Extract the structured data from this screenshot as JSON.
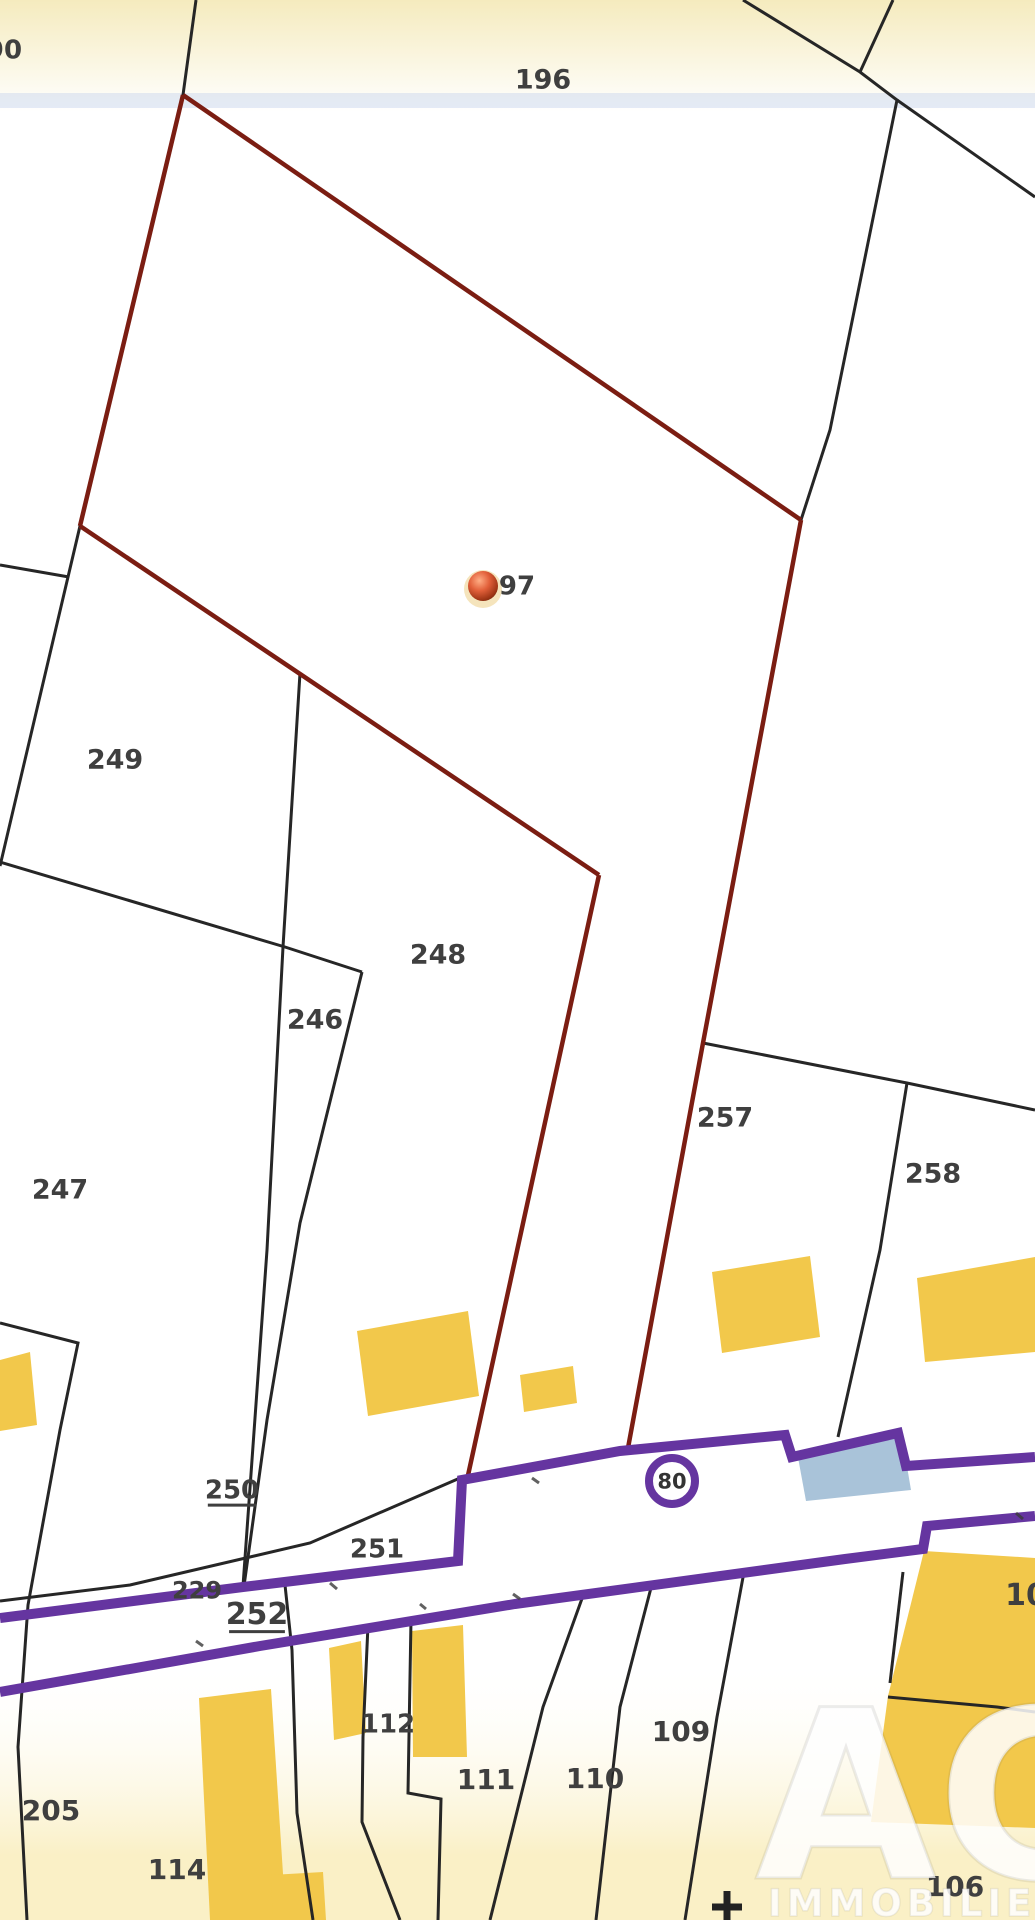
{
  "map": {
    "title": "Cadastral parcel map",
    "background": {
      "top_tint": "#f5ebbe",
      "paper": "#ffffff",
      "bottom_tint": "#faf0c6",
      "blue_band": "rgba(190,205,235,0.40)"
    },
    "palette": {
      "boundary": "#262626",
      "highlight": "#7b1d12",
      "road": "#6535a0",
      "building": "#f2c84b",
      "building_blue": "#a9c3d9",
      "label": "#3f3f3f",
      "badge_text": "#333333",
      "watermark": "#ffffff"
    },
    "parcel_labels": [
      {
        "text": "90",
        "x": 4,
        "y": 49,
        "size": 26
      },
      {
        "text": "196",
        "x": 543,
        "y": 79,
        "size": 27
      },
      {
        "text": "249",
        "x": 115,
        "y": 759,
        "size": 27
      },
      {
        "text": "247",
        "x": 60,
        "y": 1189,
        "size": 27
      },
      {
        "text": "246",
        "x": 315,
        "y": 1019,
        "size": 27
      },
      {
        "text": "248",
        "x": 438,
        "y": 954,
        "size": 27
      },
      {
        "text": "257",
        "x": 725,
        "y": 1117,
        "size": 27
      },
      {
        "text": "258",
        "x": 933,
        "y": 1173,
        "size": 27
      },
      {
        "text": "250",
        "x": 232,
        "y": 1489,
        "size": 26,
        "underline": true
      },
      {
        "text": "251",
        "x": 377,
        "y": 1548,
        "size": 26
      },
      {
        "text": "229",
        "x": 197,
        "y": 1590,
        "size": 24
      },
      {
        "text": "252",
        "x": 257,
        "y": 1613,
        "size": 30,
        "underline": true
      },
      {
        "text": "205",
        "x": 51,
        "y": 1810,
        "size": 28
      },
      {
        "text": "114",
        "x": 177,
        "y": 1869,
        "size": 28
      },
      {
        "text": "112",
        "x": 388,
        "y": 1723,
        "size": 26
      },
      {
        "text": "111",
        "x": 486,
        "y": 1779,
        "size": 28
      },
      {
        "text": "110",
        "x": 595,
        "y": 1778,
        "size": 28
      },
      {
        "text": "109",
        "x": 681,
        "y": 1731,
        "size": 28
      },
      {
        "text": "106",
        "x": 955,
        "y": 1886,
        "size": 28
      },
      {
        "text": "10",
        "x": 1026,
        "y": 1594,
        "size": 30
      }
    ],
    "road_badge": {
      "text": "80",
      "x": 672,
      "y": 1481,
      "outer_r": 27,
      "ring_width": 8,
      "font_size": 21
    },
    "marker": {
      "label": "97",
      "x": 483,
      "y": 586,
      "r": 15,
      "halo_r": 19,
      "label_x": 517,
      "label_y": 585,
      "label_size": 26
    },
    "cross_symbol": {
      "x": 727,
      "y": 1906,
      "arm": 15,
      "stroke_width": 7
    },
    "black_lines": [
      [
        [
          196,
          0
        ],
        [
          183,
          95
        ],
        [
          80,
          526
        ],
        [
          0,
          866
        ]
      ],
      [
        [
          743,
          0
        ],
        [
          860,
          72
        ],
        [
          897,
          100
        ],
        [
          830,
          430
        ],
        [
          801,
          520
        ]
      ],
      [
        [
          893,
          0
        ],
        [
          860,
          72
        ]
      ],
      [
        [
          897,
          100
        ],
        [
          1035,
          197
        ]
      ],
      [
        [
          0,
          565
        ],
        [
          69,
          577
        ]
      ],
      [
        [
          0,
          862
        ],
        [
          285,
          947
        ],
        [
          362,
          972
        ]
      ],
      [
        [
          300,
          673
        ],
        [
          283,
          947
        ],
        [
          267,
          1250
        ],
        [
          243,
          1586
        ]
      ],
      [
        [
          362,
          972
        ],
        [
          300,
          1223
        ],
        [
          267,
          1420
        ],
        [
          244,
          1586
        ]
      ],
      [
        [
          0,
          1323
        ],
        [
          78,
          1343
        ],
        [
          60,
          1430
        ],
        [
          38,
          1550
        ],
        [
          28,
          1605
        ],
        [
          18,
          1747
        ],
        [
          27,
          1920
        ]
      ],
      [
        [
          460,
          1478
        ],
        [
          310,
          1543
        ],
        [
          130,
          1585
        ],
        [
          0,
          1601
        ]
      ],
      [
        [
          285,
          1585
        ],
        [
          292,
          1650
        ],
        [
          297,
          1813
        ],
        [
          313,
          1920
        ]
      ],
      [
        [
          368,
          1625
        ],
        [
          363,
          1737
        ],
        [
          362,
          1822
        ],
        [
          400,
          1920
        ]
      ],
      [
        [
          411,
          1620
        ],
        [
          408,
          1793
        ],
        [
          441,
          1799
        ],
        [
          438,
          1920
        ]
      ],
      [
        [
          584,
          1593
        ],
        [
          543,
          1707
        ],
        [
          490,
          1920
        ]
      ],
      [
        [
          652,
          1584
        ],
        [
          620,
          1707
        ],
        [
          596,
          1920
        ]
      ],
      [
        [
          744,
          1572
        ],
        [
          717,
          1717
        ],
        [
          685,
          1920
        ]
      ],
      [
        [
          903,
          1572
        ],
        [
          890,
          1683
        ]
      ],
      [
        [
          888,
          1697
        ],
        [
          997,
          1707
        ],
        [
          1035,
          1712
        ]
      ],
      [
        [
          703,
          1043
        ],
        [
          907,
          1083
        ],
        [
          1035,
          1110
        ]
      ],
      [
        [
          907,
          1083
        ],
        [
          880,
          1250
        ],
        [
          838,
          1437
        ]
      ]
    ],
    "red_lines": [
      [
        [
          183,
          95
        ],
        [
          801,
          520
        ]
      ],
      [
        [
          801,
          520
        ],
        [
          703,
          1043
        ],
        [
          628,
          1448
        ]
      ],
      [
        [
          183,
          95
        ],
        [
          80,
          526
        ]
      ],
      [
        [
          80,
          526
        ],
        [
          599,
          875
        ]
      ],
      [
        [
          599,
          875
        ],
        [
          467,
          1480
        ]
      ]
    ],
    "purple_lines": [
      [
        [
          0,
          1618
        ],
        [
          243,
          1587
        ],
        [
          458,
          1561
        ],
        [
          462,
          1480
        ],
        [
          620,
          1451
        ],
        [
          785,
          1435
        ],
        [
          792,
          1457
        ],
        [
          898,
          1433
        ],
        [
          906,
          1466
        ],
        [
          1035,
          1457
        ]
      ],
      [
        [
          0,
          1692
        ],
        [
          260,
          1646
        ],
        [
          515,
          1604
        ],
        [
          845,
          1559
        ],
        [
          923,
          1549
        ],
        [
          927,
          1526
        ],
        [
          1035,
          1516
        ]
      ]
    ],
    "buildings": [
      {
        "name": "building-114-main",
        "points": [
          [
            199,
            1698
          ],
          [
            271,
            1689
          ],
          [
            286,
            1920
          ],
          [
            210,
            1920
          ]
        ]
      },
      {
        "name": "building-114-annex",
        "points": [
          [
            271,
            1875
          ],
          [
            323,
            1872
          ],
          [
            326,
            1920
          ],
          [
            273,
            1920
          ]
        ]
      },
      {
        "name": "building-112-west",
        "points": [
          [
            329,
            1648
          ],
          [
            361,
            1641
          ],
          [
            366,
            1733
          ],
          [
            334,
            1740
          ]
        ]
      },
      {
        "name": "building-112-east",
        "points": [
          [
            412,
            1631
          ],
          [
            463,
            1625
          ],
          [
            467,
            1757
          ],
          [
            413,
            1757
          ]
        ]
      },
      {
        "name": "building-248-leg-large",
        "points": [
          [
            357,
            1331
          ],
          [
            468,
            1311
          ],
          [
            479,
            1396
          ],
          [
            368,
            1416
          ]
        ]
      },
      {
        "name": "building-248-leg-small",
        "points": [
          [
            520,
            1375
          ],
          [
            573,
            1366
          ],
          [
            577,
            1403
          ],
          [
            524,
            1412
          ]
        ]
      },
      {
        "name": "building-257",
        "points": [
          [
            712,
            1272
          ],
          [
            810,
            1256
          ],
          [
            820,
            1337
          ],
          [
            722,
            1353
          ]
        ]
      },
      {
        "name": "building-258",
        "points": [
          [
            917,
            1278
          ],
          [
            1035,
            1257
          ],
          [
            1035,
            1352
          ],
          [
            925,
            1362
          ]
        ]
      },
      {
        "name": "building-left-edge",
        "points": [
          [
            0,
            1360
          ],
          [
            30,
            1352
          ],
          [
            37,
            1425
          ],
          [
            0,
            1431
          ]
        ]
      },
      {
        "name": "building-106",
        "points": [
          [
            924,
            1551
          ],
          [
            1035,
            1558
          ],
          [
            1035,
            1828
          ],
          [
            871,
            1822
          ],
          [
            888,
            1696
          ]
        ]
      }
    ],
    "blue_building": {
      "name": "building-roadside-blue",
      "points": [
        [
          797,
          1452
        ],
        [
          901,
          1431
        ],
        [
          911,
          1490
        ],
        [
          806,
          1501
        ]
      ]
    },
    "road_ticks": [
      [
        [
          330,
          1583
        ],
        [
          337,
          1589
        ]
      ],
      [
        [
          532,
          1478
        ],
        [
          539,
          1483
        ]
      ],
      [
        [
          513,
          1594
        ],
        [
          520,
          1599
        ]
      ],
      [
        [
          1016,
          1513
        ],
        [
          1023,
          1519
        ]
      ],
      [
        [
          196,
          1641
        ],
        [
          203,
          1646
        ]
      ],
      [
        [
          420,
          1604
        ],
        [
          426,
          1609
        ]
      ]
    ],
    "watermark": {
      "monogram": "AC",
      "name": "IMMOBILIER",
      "monogram_x": 755,
      "monogram_y": 1878,
      "monogram_size": 235,
      "name_x": 768,
      "name_y": 1916,
      "name_size": 37,
      "opacity": 0.85
    }
  }
}
